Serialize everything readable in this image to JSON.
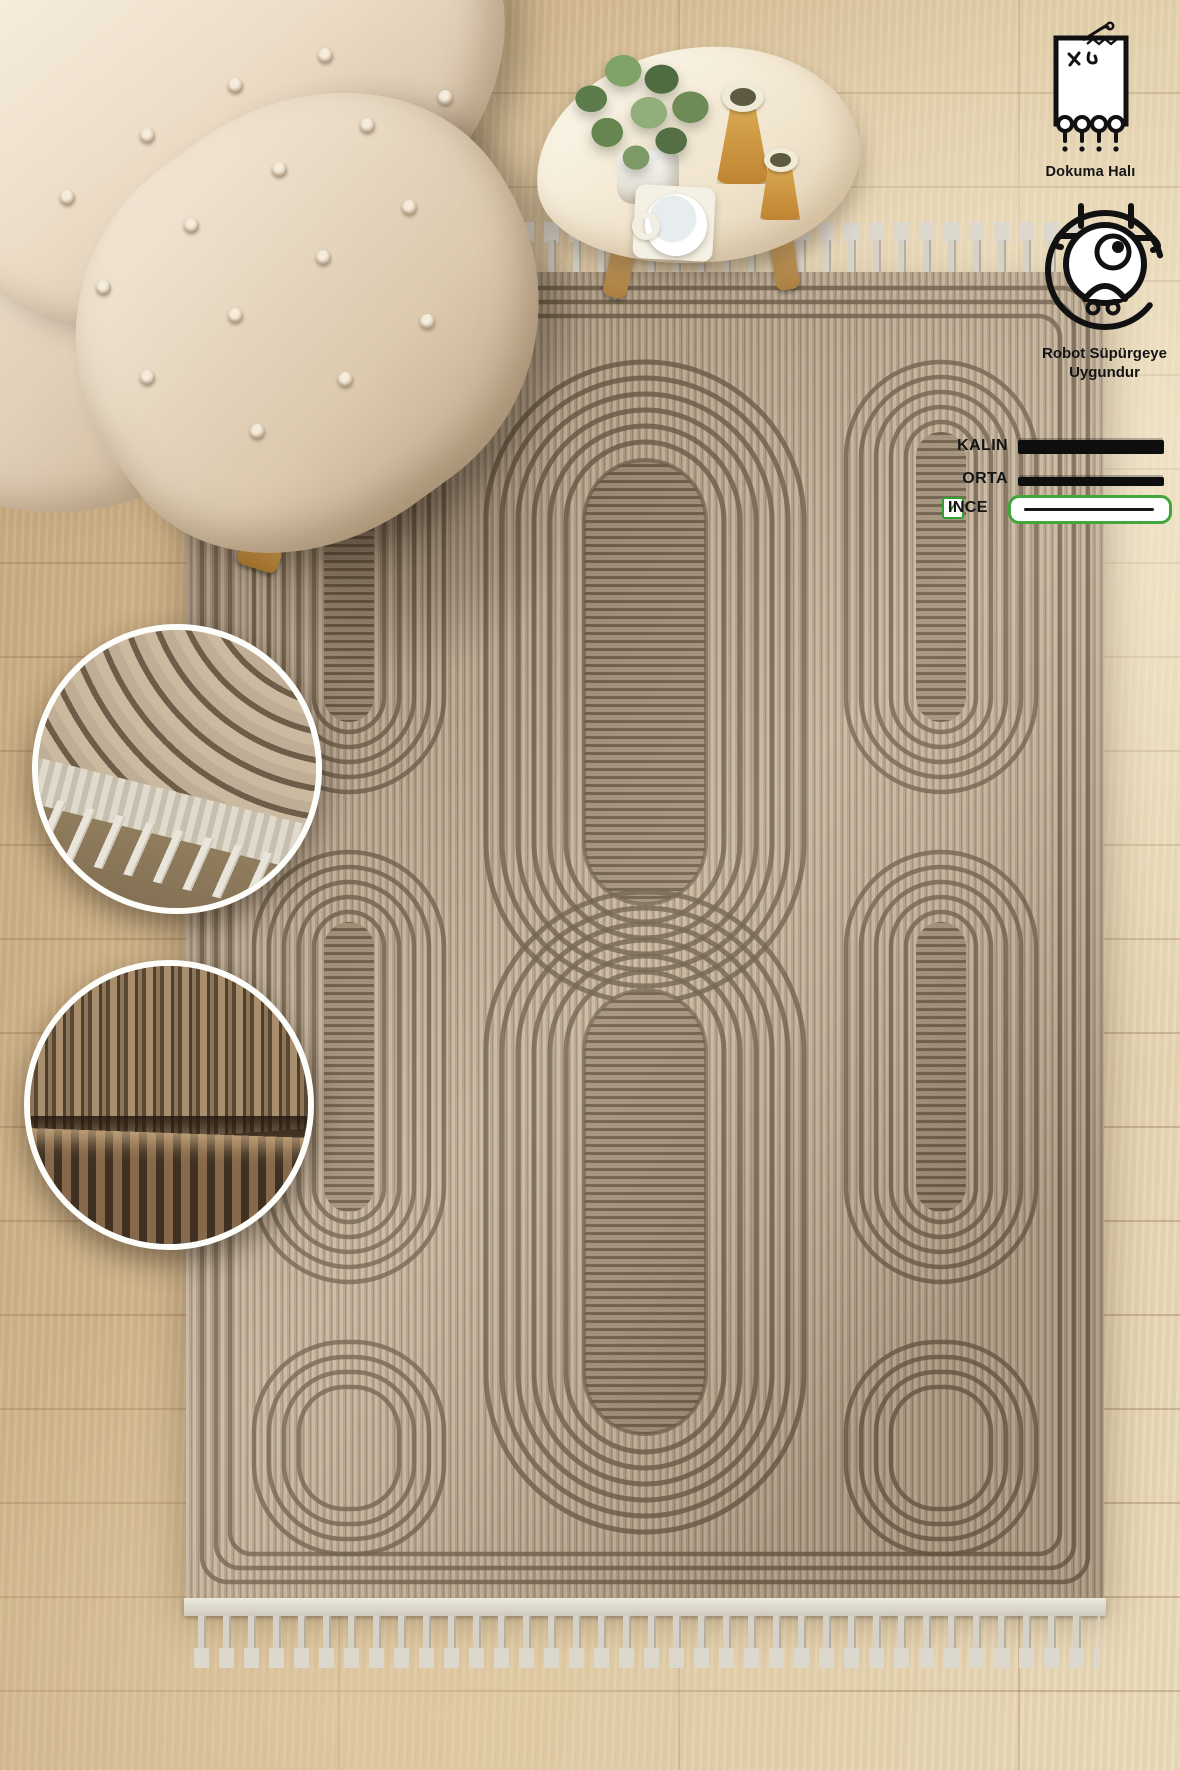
{
  "image": {
    "type": "product-photo",
    "subject": "Beige woven area rug with geometric chain pattern, top view, with armchair and coffee table"
  },
  "badges": {
    "woven": {
      "icon": "woven-rug-icon",
      "label": "Dokuma Halı"
    },
    "robot": {
      "icon": "robot-vacuum-icon",
      "lines": [
        "Robot Süpürgeye",
        "Uygundur"
      ]
    }
  },
  "thickness_legend": {
    "check_glyph": "✓",
    "options": [
      {
        "label": "KALIN",
        "thickness": "thick",
        "checked": false
      },
      {
        "label": "ORTA",
        "thickness": "medium",
        "checked": false
      },
      {
        "label": "INCE",
        "thickness": "thin",
        "checked": true
      }
    ]
  },
  "colors": {
    "legend_green": "#2ea32e",
    "ink": "#141414",
    "rug_field": "#bcab93",
    "rug_lines": "#6a5a46",
    "fringe": "#d7d2c7",
    "floor": "#d8c09b"
  },
  "scene": {
    "items": [
      "tufted cream armchair",
      "cream organic-shaped coffee table with plant, mug and two amber vases",
      "patterned rug with fringed ends",
      "detail inset: rug corner with tassels",
      "detail inset: folded rug texture"
    ]
  }
}
